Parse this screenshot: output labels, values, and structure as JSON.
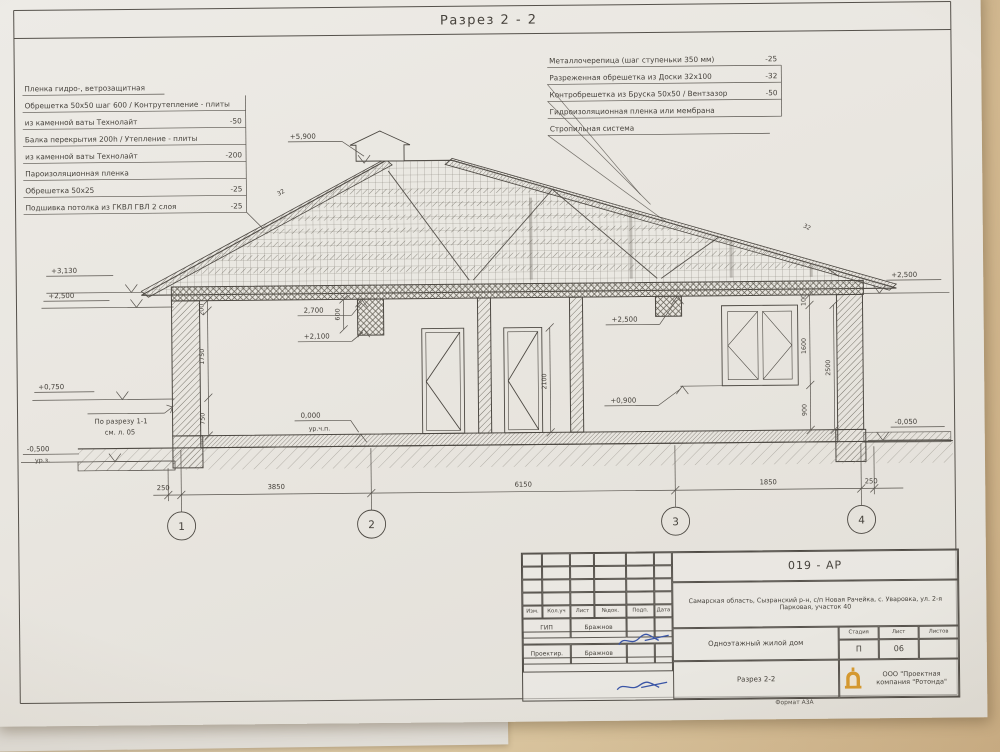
{
  "sheet": {
    "title": "Разрез 2 - 2"
  },
  "left_notes": [
    {
      "text": "Пленка гидро-, ветрозащитная",
      "value": ""
    },
    {
      "text": "Обрешетка 50х50 шаг 600 / Контрутепление - плиты",
      "value": ""
    },
    {
      "text": "из каменной ваты Технолайт",
      "value": "-50"
    },
    {
      "text": "Балка перекрытия 200h / Утепление - плиты",
      "value": ""
    },
    {
      "text": "из каменной ваты Технолайт",
      "value": "-200"
    },
    {
      "text": "Пароизоляционная пленка",
      "value": ""
    },
    {
      "text": "Обрешетка 50х25",
      "value": "-25"
    },
    {
      "text": "Подшивка потолка из ГКВЛ ГВЛ 2 слоя",
      "value": "-25"
    }
  ],
  "right_notes": [
    {
      "text": "Металлочерепица (шаг ступеньки 350 мм)",
      "value": "-25"
    },
    {
      "text": "Разреженная обрешетка из Доски 32х100",
      "value": "-32"
    },
    {
      "text": "Контробрешетка из Бруска 50х50 / Вентзазор",
      "value": "-50"
    },
    {
      "text": "Гидроизоляционная пленка или мембрана",
      "value": ""
    },
    {
      "text": "Стропильная система",
      "value": ""
    }
  ],
  "elevations": {
    "ridge": "+5,900",
    "left_1": "+3,130",
    "left_2": "+2,500",
    "left_3": "+0,750",
    "left_4": "-0,500",
    "ground_label": "ур.з.",
    "int_ceiling": "2,700",
    "int_door": "+2,100",
    "int_floor": "0,000",
    "floor_label": "ур.ч.п.",
    "mid_top": "+2,500",
    "mid_sill": "+0,900",
    "right_top": "+2,500",
    "right_porch": "-0,050"
  },
  "ref_note": {
    "line1": "По разрезу 1-1",
    "line2": "см. л. 05"
  },
  "dims": {
    "bottom": [
      "250",
      "3850",
      "6150",
      "1850",
      "250"
    ],
    "left_chain": [
      "200",
      "1750",
      "750"
    ],
    "ceiling_offset": "600",
    "door_height": "2100",
    "right_chain": [
      "100",
      "1600",
      "900"
    ],
    "right_total": "2500",
    "slope_left": "32",
    "slope_right": "32"
  },
  "axes": [
    "1",
    "2",
    "3",
    "4"
  ],
  "titleblock": {
    "code": "019 - АР",
    "address": "Самарская область, Сызранский р-н, с/п Новая Рачейка, с. Уваровка, ул. 2-я Парковая, участок 40",
    "object_name": "Одноэтажный жилой дом",
    "sheet_name": "Разрез 2-2",
    "company": "ООО \"Проектная компания \"Ротонда\"",
    "format": "Формат А3А",
    "stage_label": "Стадия",
    "sheet_label": "Лист",
    "sheets_label": "Листов",
    "stage_value": "П",
    "sheet_value": "06",
    "sheets_value": "",
    "rev_headers": [
      "Изм.",
      "Кол.уч",
      "Лист",
      "№док.",
      "Подп.",
      "Дата"
    ],
    "signer1_role": "ГИП",
    "signer1_name": "Бражнов",
    "signer2_role": "Проектир.",
    "signer2_name": "Бражнов"
  }
}
